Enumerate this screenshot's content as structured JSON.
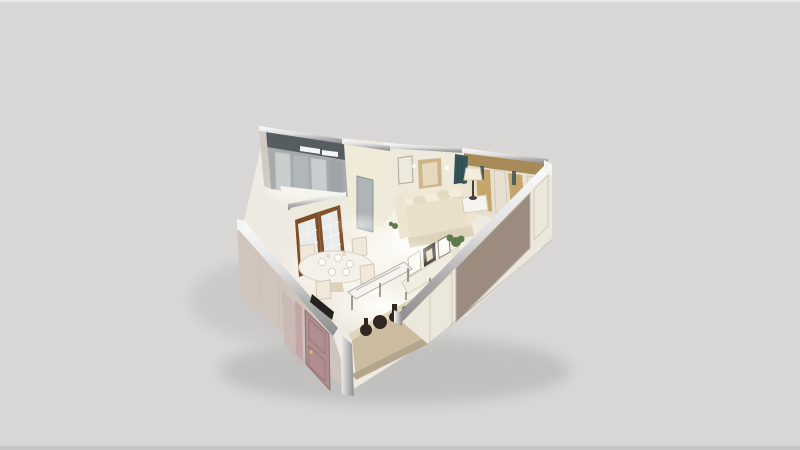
{
  "image": {
    "width": 800,
    "height": 450,
    "kind": "3d-dollhouse-floorplan-render",
    "description": "Photorealistic isometric cutaway render of a small L-shaped apartment seen from above on a plain light-gray backdrop; cut wall tops have polished chrome bands.",
    "text_visible": "none"
  },
  "scene": {
    "view": "isometric top-down cutaway, apartment centered slightly right",
    "rooms": [
      {
        "name": "kitchen-corridor",
        "position": "upper-left wing",
        "features": [
          "dark mirrored upper band",
          "gray cabinet fronts",
          "chrome glints",
          "gray interior door to living room"
        ]
      },
      {
        "name": "living-room",
        "position": "center and right",
        "features": [
          "cream three-seat sofa with pillows",
          "gold framed artwork and wall niche above sofa",
          "table lamp on white side table",
          "dark teal corner curtain",
          "wardrobe wall with gold drapes and cream pilasters",
          "white media console with leaning framed prints",
          "green potted plant"
        ]
      },
      {
        "name": "dining-area",
        "position": "lower-left",
        "features": [
          "round white table set with dishes and glasses",
          "cream upholstered chairs",
          "wood-framed french glass doors",
          "marble-top serving table",
          "tan sideboard with dark vases and small plant"
        ]
      }
    ],
    "exterior": {
      "left_wall": "beige plaster with dusty-pink paneled entry door, pink sidelight and black entry accent",
      "right_wall": "white paneled face with large taupe inset panel",
      "wall_tops": "polished chrome / mirror bands",
      "floor": "pale marble with bright warm light pools"
    }
  },
  "colors": {
    "background": "#d8d7d5",
    "topEdge": "#e9e8e6",
    "bottomEdge": "#c7c6c4",
    "floor": "#efeae1",
    "glowWhite": "#ffffff",
    "corridorGray": "#a7abac",
    "corridorDark": "#565d60",
    "cabinetLight": "#c8cdcd",
    "cabinetMid": "#b1b7b8",
    "cabinetDark": "#9fa5a7",
    "glint": "#f3f4f4",
    "wallCream": "#eee9dd",
    "wallBright": "#f0ead9",
    "wallWarm": "#e7e0d0",
    "valanceGold": "#a68b58",
    "curtainGold": "#c6a56b",
    "pilaster": "#efe9da",
    "tealCurtain": "#35545a",
    "sofaBack": "#f0e7d4",
    "sofaSeat": "#e9dfca",
    "sofaSkirt": "#ddd2ba",
    "armrest": "#eee4cf",
    "pillowLight": "#f4eddc",
    "pillowAlt": "#e6d9c2",
    "artGold": "#cdb489",
    "artInner": "#e6d9bd",
    "niche": "#f7f4ec",
    "grayDoor": "#adb5b7",
    "woodDoorA": "#7c4d27",
    "woodDoorB": "#82522a",
    "glass": "#e9ecea",
    "tableWhite": "#f4f1ea",
    "chairCream": "#f0e9db",
    "dishWhite": "#ffffff",
    "consoleWhite": "#f1ece0",
    "frameWhite": "#fdfcf8",
    "frameDark": "#3c3a36",
    "plantGreen": "#5f7a4a",
    "potCream": "#e8e3d6",
    "marble": "#f6f4f0",
    "consoleTan": "#cbbb9f",
    "consoleTop": "#e0d4bc",
    "consoleBase": "#b3a68c",
    "vaseDark": "#32271e",
    "sePanelWhite": "#f0ecdf",
    "taupePanel": "#9c8c80",
    "seFace": "#ebe7da",
    "swFace": "#d0c5bd",
    "swPink": "#c8b3ae",
    "mauveDoor": "#b08e8f",
    "mauveSide": "#c4a6a6",
    "accentBlack": "#232220",
    "exteriorThin": "#cfcac4",
    "chrome": "#c9c9c9",
    "shadow": "#000000"
  }
}
